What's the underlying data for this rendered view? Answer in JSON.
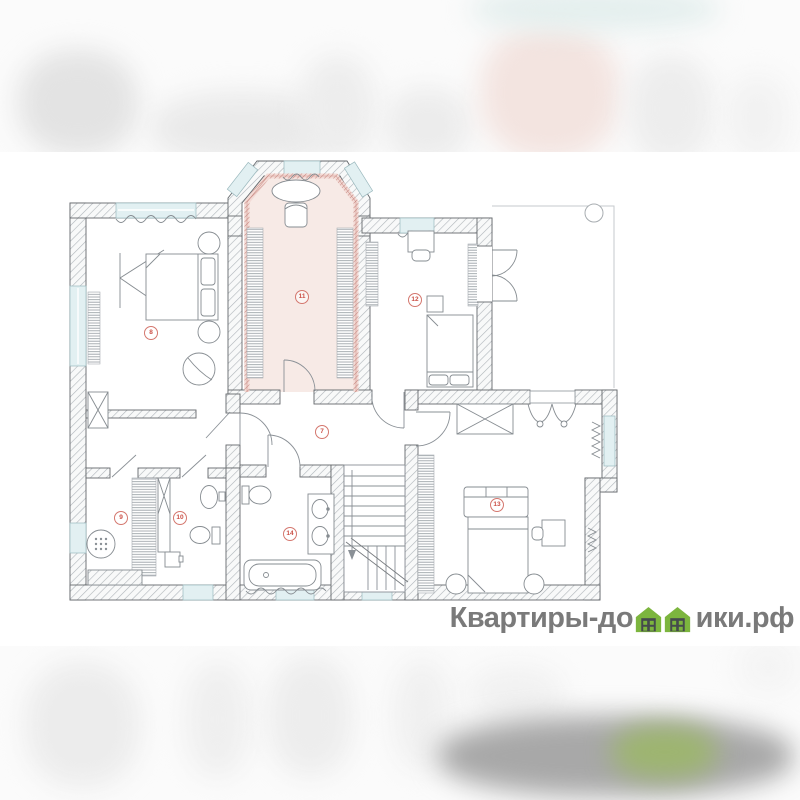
{
  "page": {
    "background": "#ffffff",
    "description": "floor-plan image with blurred letterbox bands"
  },
  "watermark": {
    "prefix": "Квартиры-до",
    "suffix": "ики.рф",
    "full_text": "Квартиры-домики.рф",
    "text_color": "#7a7a7a",
    "house_green": "#7cb53e"
  },
  "plan": {
    "accent": {
      "highlight_fill": "#f7eae6",
      "highlight_hatch_red": "#c5837c",
      "badge_red": "#cb4f45",
      "window_blue": "#e2f0f2",
      "wall_outline": "#64686c"
    },
    "rooms": [
      {
        "number": "8",
        "label": "bedroom-left"
      },
      {
        "number": "11",
        "label": "dressing-hall-highlighted"
      },
      {
        "number": "12",
        "label": "bedroom-top-right"
      },
      {
        "number": "7",
        "label": "corridor"
      },
      {
        "number": "9",
        "label": "shower-room"
      },
      {
        "number": "10",
        "label": "wc"
      },
      {
        "number": "14",
        "label": "bathroom"
      },
      {
        "number": "13",
        "label": "bedroom-bottom-right"
      }
    ],
    "fixtures": [
      "double-bed",
      "wardrobe",
      "armchair",
      "oval-table",
      "desk-chair",
      "bathtub",
      "double-sink-vanity",
      "toilet",
      "wash-basin",
      "shower-drain",
      "staircase-down",
      "sofa",
      "pouf",
      "radiator",
      "hanger-rail",
      "french-doors",
      "bay-window"
    ]
  }
}
